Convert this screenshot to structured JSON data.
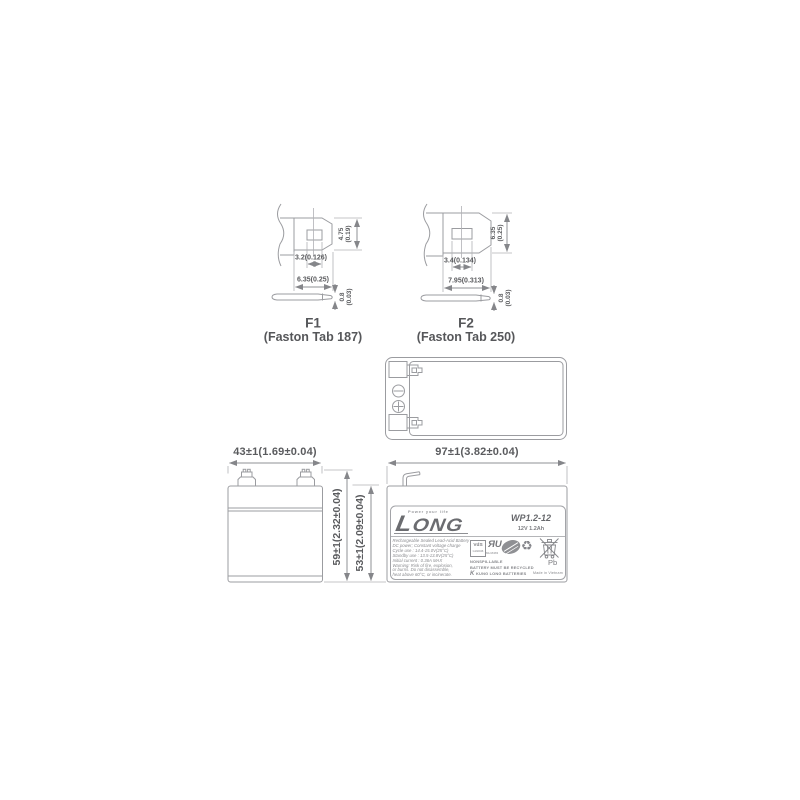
{
  "colors": {
    "line": "#9b9ca0",
    "dim_text": "#5a5b5e",
    "label_text": "#8a8b8f",
    "arrow": "#85868a"
  },
  "f1": {
    "title": "F1",
    "subtitle": "(Faston Tab 187)",
    "height_mm": "4.75",
    "height_in": "(0.19)",
    "hole_dim": "3.2(0.126)",
    "width_dim": "6.35(0.25)",
    "thick_mm": "0.8",
    "thick_in": "(0.03)"
  },
  "f2": {
    "title": "F2",
    "subtitle": "(Faston Tab 250)",
    "height_mm": "6.35",
    "height_in": "(0.25)",
    "hole_dim": "3.4(0.134)",
    "width_dim": "7.95(0.313)",
    "thick_mm": "0.8",
    "thick_in": "(0.03)"
  },
  "views": {
    "front_width_dim": "43±1(1.69±0.04)",
    "total_height_dim": "59±1(2.32±0.04)",
    "body_height_dim": "53±1(2.09±0.04)",
    "side_width_dim": "97±1(3.82±0.04)"
  },
  "label": {
    "tagline": "Power your life",
    "brand": "LONG",
    "model": "WP1.2-12",
    "rating": "12V 1.2Ah",
    "description_lines": [
      "Rechargeable Sealed Lead-Acid Battery",
      "DC power; Constant voltage charge",
      "Cycle use : 14.4-15.0V(25°C)",
      "Standby use : 13.5-13.8V(25°C)",
      "Initial current : 0.36A MAX",
      "Warning: Risk of fire, explosion,",
      "or burns. Do not disassemble,",
      "heat above 60°C, or incinerate."
    ],
    "vds": "VdS",
    "vds_num": "G192046",
    "ul_mark": "ЯU",
    "ul_num": "MH16383",
    "recycle_glyph": "♻",
    "nonspillable": "NONSPILLABLE",
    "recycle_text": "BATTERY MUST BE RECYCLED",
    "company_mark": "K",
    "company": "KUNG LONG BATTERIES",
    "origin": "Made in Vietnam",
    "pb": "Pb"
  }
}
